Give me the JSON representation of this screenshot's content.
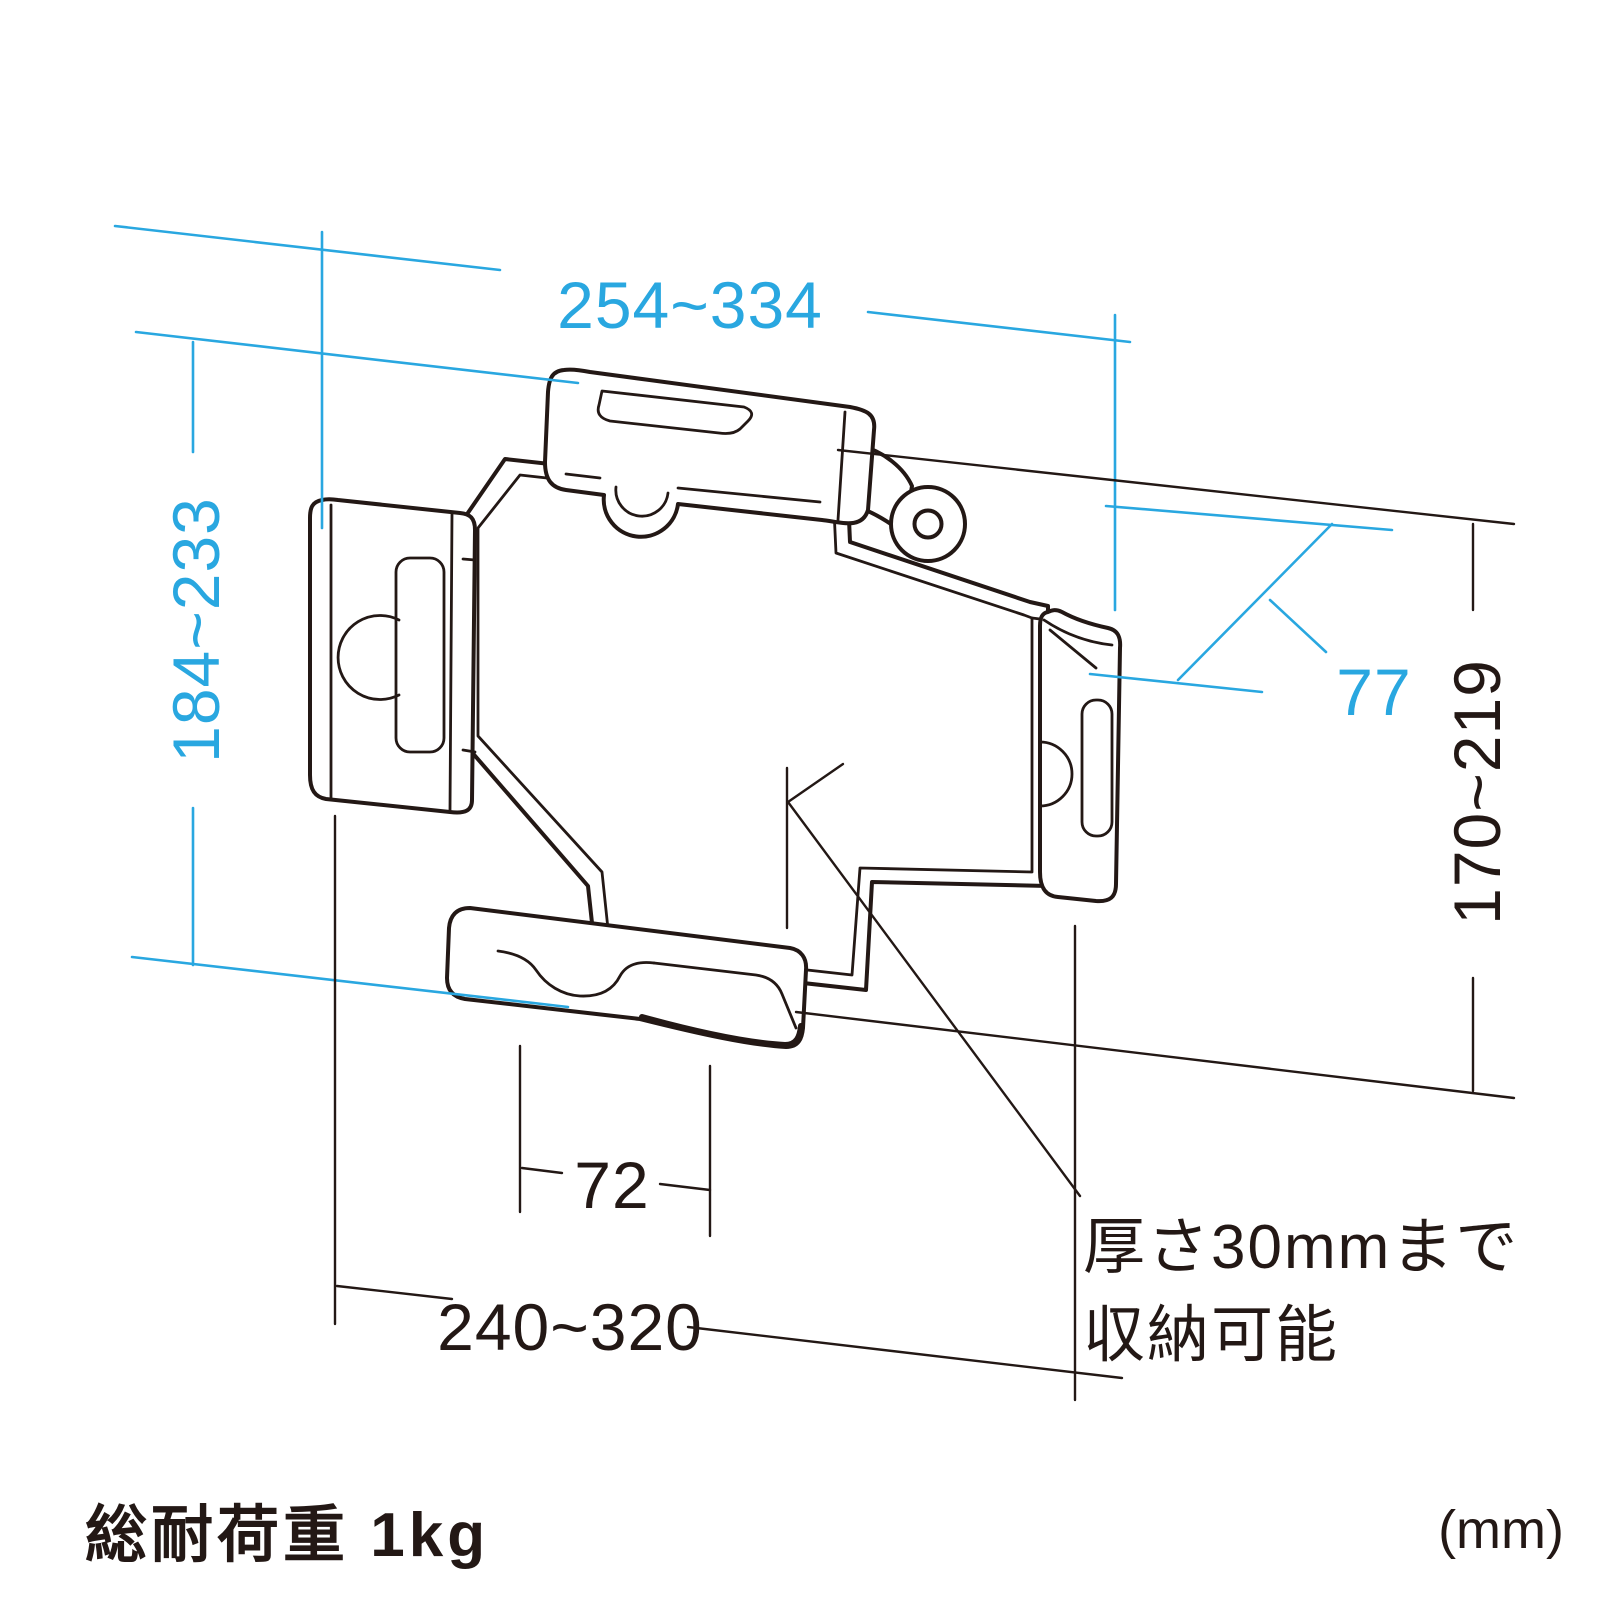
{
  "title": "tablet-holder-dimension-diagram",
  "colors": {
    "accent": "#29A7E0",
    "ink": "#231815",
    "background": "#ffffff"
  },
  "dims": {
    "top_width": "254~334",
    "left_height": "184~233",
    "depth": "77",
    "right_height": "170~219",
    "slot_width": "72",
    "bottom_width": "240~320"
  },
  "notes": {
    "thickness_line1": "厚さ30mmまで",
    "thickness_line2": "収納可能"
  },
  "footer": {
    "load_capacity": "総耐荷重 1kg",
    "unit": "(mm)"
  }
}
